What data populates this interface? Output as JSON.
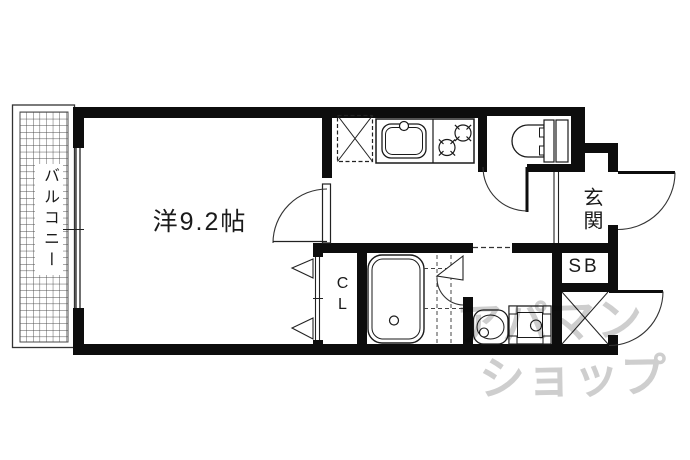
{
  "plan": {
    "rooms": {
      "main_room": {
        "label": "洋9.2帖"
      },
      "balcony": {
        "label": "バルコニー"
      },
      "entrance": {
        "label": "玄関"
      },
      "shoe_box": {
        "label": "SB"
      },
      "closet": {
        "label": "CL"
      }
    },
    "watermark": {
      "line1": "アパマン",
      "line2": "ショップ"
    },
    "colors": {
      "wall": "#0d0d0d",
      "line": "#222222",
      "watermark": "#cecece",
      "background": "#ffffff"
    }
  }
}
